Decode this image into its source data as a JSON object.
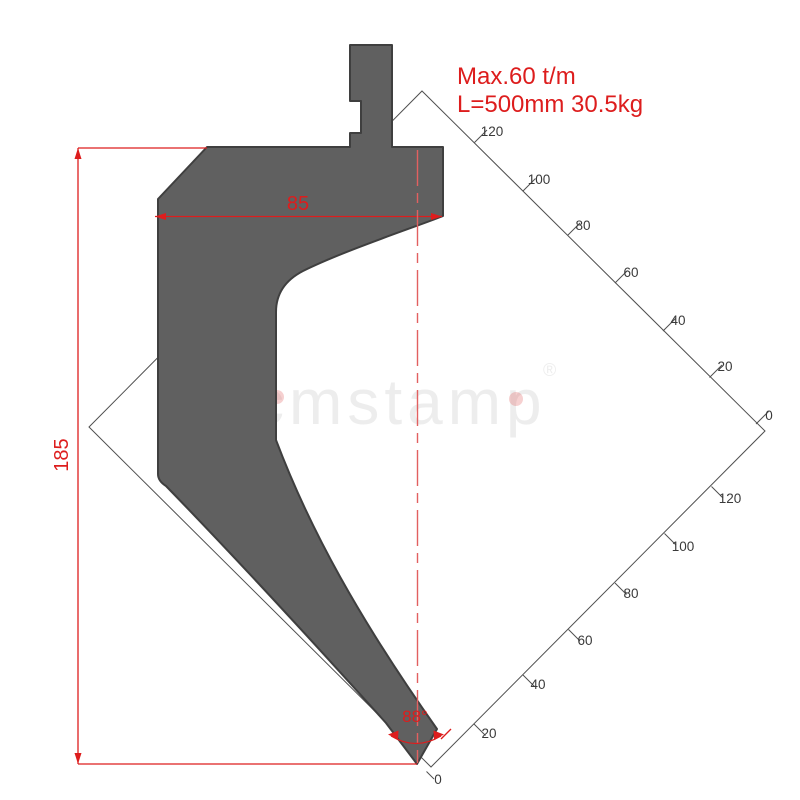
{
  "annotations": {
    "max_load": "Max.60 t/m",
    "length_weight": "L=500mm 30.5kg"
  },
  "dimensions": {
    "width": "85",
    "height": "185",
    "tip_angle": "88°"
  },
  "grid": {
    "ne_labels": [
      "120",
      "100",
      "80",
      "60",
      "40",
      "20",
      "0"
    ],
    "se_labels": [
      "120",
      "100",
      "80",
      "60",
      "40",
      "20",
      "0"
    ]
  },
  "watermark": {
    "text": "cmstamp",
    "reg": "®"
  },
  "colors": {
    "accent": "#dd1d1d",
    "centerline": "#e26060",
    "body": "#606060",
    "body_outline": "#3f3f3f",
    "grid_line": "#4f4f4f",
    "grid_label": "#3a3a3a",
    "watermark": "#c9c9c9",
    "wm_dot": "#dd5555"
  }
}
